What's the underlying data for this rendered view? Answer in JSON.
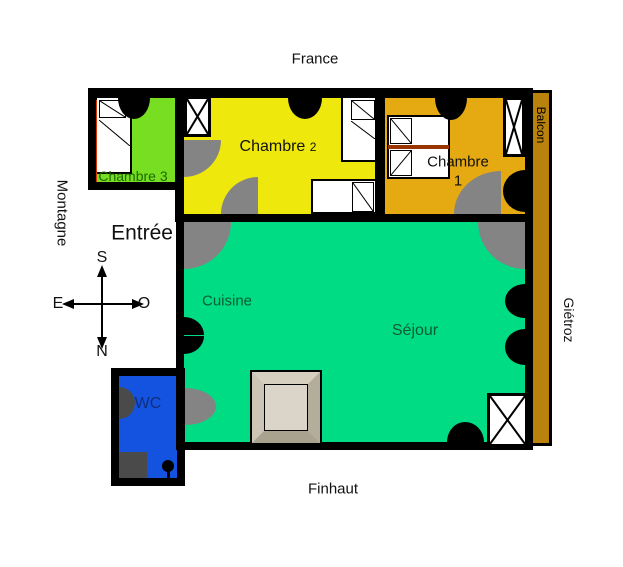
{
  "surroundings": {
    "top": "France",
    "left": "Montagne",
    "right": "Giétroz",
    "bottom": "Finhaut"
  },
  "compass": {
    "south": "S",
    "north": "N",
    "east": "E",
    "west": "O"
  },
  "rooms": {
    "chambre2": {
      "name": "Chambre",
      "number": "2",
      "color": "#EFE80D"
    },
    "chambre3": {
      "name": "Chambre 3",
      "color": "#77DE21"
    },
    "chambre1": {
      "name": "Chambre",
      "number": "1",
      "color": "#E5A912"
    },
    "entree": {
      "name": "Entrée"
    },
    "cuisine": {
      "name": "Cuisine"
    },
    "sejour": {
      "name": "Séjour",
      "color": "#00DC84"
    },
    "wc": {
      "name": "WC",
      "color": "#1453E0"
    },
    "balcon": {
      "name": "Balcon",
      "color": "#B8820D"
    }
  }
}
